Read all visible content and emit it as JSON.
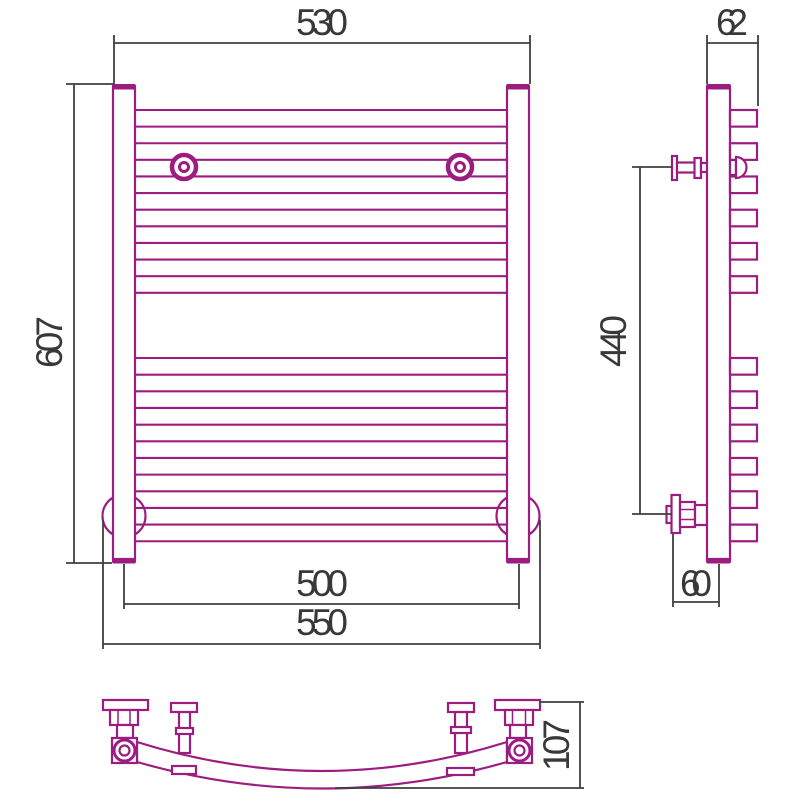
{
  "drawing": {
    "title": "heated towel rail technical drawing",
    "colors": {
      "product_line": "#9c1c80",
      "dimension_line": "#3f3f3f",
      "background": "#ffffff"
    },
    "views": {
      "front": {
        "label": "front view",
        "tube_count": 12,
        "tube_groups": 2,
        "tubes_per_group": 6
      },
      "side": {
        "label": "side view"
      },
      "bottom": {
        "label": "bottom view (curved tube)"
      }
    },
    "dimensions": {
      "top_width": "530",
      "overall_height": "607",
      "post_center_spacing": "500",
      "overall_width": "550",
      "side_depth": "62",
      "bracket_vertical_spacing": "440",
      "wall_to_post": "60",
      "curve_depth": "107"
    }
  }
}
